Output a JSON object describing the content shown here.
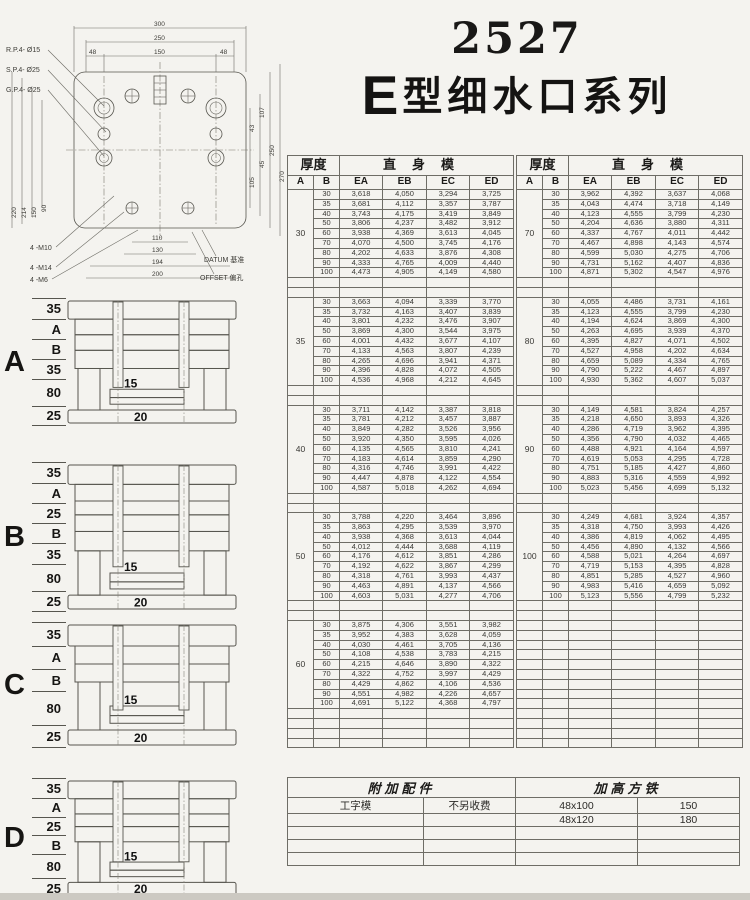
{
  "page": {
    "title_number": "2527",
    "title_series_e": "E",
    "title_series_rest": "型细水口系列"
  },
  "drawing": {
    "hole_labels": [
      "R.P.4- Ø15",
      "S.P.4- Ø25",
      "G.P.4- Ø25"
    ],
    "thread_labels": [
      "4 -M10",
      "4 -M14",
      "4 -M6"
    ],
    "dims_top": [
      "300",
      "250",
      "48",
      "150",
      "48"
    ],
    "dims_right": [
      "43",
      "105",
      "45",
      "107",
      "250",
      "270"
    ],
    "dims_left": [
      "220",
      "214",
      "150",
      "90"
    ],
    "dims_bottom": [
      "110",
      "130",
      "194",
      "200"
    ],
    "datum_label": "DATUM 基准",
    "offset_label": "OFFSET 偏孔"
  },
  "diagrams": [
    {
      "label": "A",
      "dims": [
        "35",
        "A",
        "B",
        "35",
        "80",
        "25"
      ],
      "inner_dim": "15",
      "bottom_dim": "20"
    },
    {
      "label": "B",
      "dims": [
        "35",
        "A",
        "25",
        "B",
        "35",
        "80",
        "25"
      ],
      "inner_dim": "15",
      "bottom_dim": "20"
    },
    {
      "label": "C",
      "dims": [
        "35",
        "A",
        "B",
        "80",
        "25"
      ],
      "inner_dim": "15",
      "bottom_dim": "20"
    },
    {
      "label": "D",
      "dims": [
        "35",
        "A",
        "25",
        "B",
        "80",
        "25"
      ],
      "inner_dim": "15",
      "bottom_dim": "20"
    }
  ],
  "spec_header": {
    "thickness": "厚度",
    "straight": "直身模",
    "col_a": "A",
    "col_b": "B",
    "cols": [
      "EA",
      "EB",
      "EC",
      "ED"
    ]
  },
  "spec_tables": [
    {
      "groups": [
        {
          "a": "30",
          "rows": [
            [
              "30",
              "3,618",
              "4,050",
              "3,294",
              "3,725"
            ],
            [
              "35",
              "3,681",
              "4,112",
              "3,357",
              "3,787"
            ],
            [
              "40",
              "3,743",
              "4,175",
              "3,419",
              "3,849"
            ],
            [
              "50",
              "3,806",
              "4,237",
              "3,482",
              "3,912"
            ],
            [
              "60",
              "3,938",
              "4,369",
              "3,613",
              "4,045"
            ],
            [
              "70",
              "4,070",
              "4,500",
              "3,745",
              "4,176"
            ],
            [
              "80",
              "4,202",
              "4,633",
              "3,876",
              "4,308"
            ],
            [
              "90",
              "4,333",
              "4,765",
              "4,009",
              "4,440"
            ],
            [
              "100",
              "4,473",
              "4,905",
              "4,149",
              "4,580"
            ]
          ]
        },
        {
          "a": "35",
          "rows": [
            [
              "30",
              "3,663",
              "4,094",
              "3,339",
              "3,770"
            ],
            [
              "35",
              "3,732",
              "4,163",
              "3,407",
              "3,839"
            ],
            [
              "40",
              "3,801",
              "4,232",
              "3,476",
              "3,907"
            ],
            [
              "50",
              "3,869",
              "4,300",
              "3,544",
              "3,975"
            ],
            [
              "60",
              "4,001",
              "4,432",
              "3,677",
              "4,107"
            ],
            [
              "70",
              "4,133",
              "4,563",
              "3,807",
              "4,239"
            ],
            [
              "80",
              "4,265",
              "4,696",
              "3,941",
              "4,371"
            ],
            [
              "90",
              "4,396",
              "4,828",
              "4,072",
              "4,505"
            ],
            [
              "100",
              "4,536",
              "4,968",
              "4,212",
              "4,645"
            ]
          ]
        },
        {
          "a": "40",
          "rows": [
            [
              "30",
              "3,711",
              "4,142",
              "3,387",
              "3,818"
            ],
            [
              "35",
              "3,781",
              "4,212",
              "3,457",
              "3,887"
            ],
            [
              "40",
              "3,849",
              "4,282",
              "3,526",
              "3,956"
            ],
            [
              "50",
              "3,920",
              "4,350",
              "3,595",
              "4,026"
            ],
            [
              "60",
              "4,135",
              "4,565",
              "3,810",
              "4,241"
            ],
            [
              "70",
              "4,183",
              "4,614",
              "3,859",
              "4,290"
            ],
            [
              "80",
              "4,316",
              "4,746",
              "3,991",
              "4,422"
            ],
            [
              "90",
              "4,447",
              "4,878",
              "4,122",
              "4,554"
            ],
            [
              "100",
              "4,587",
              "5,018",
              "4,262",
              "4,694"
            ]
          ]
        },
        {
          "a": "50",
          "rows": [
            [
              "30",
              "3,788",
              "4,220",
              "3,464",
              "3,896"
            ],
            [
              "35",
              "3,863",
              "4,295",
              "3,539",
              "3,970"
            ],
            [
              "40",
              "3,938",
              "4,368",
              "3,613",
              "4,044"
            ],
            [
              "50",
              "4,012",
              "4,444",
              "3,688",
              "4,119"
            ],
            [
              "60",
              "4,176",
              "4,612",
              "3,851",
              "4,286"
            ],
            [
              "70",
              "4,192",
              "4,622",
              "3,867",
              "4,299"
            ],
            [
              "80",
              "4,318",
              "4,761",
              "3,993",
              "4,437"
            ],
            [
              "90",
              "4,463",
              "4,891",
              "4,137",
              "4,566"
            ],
            [
              "100",
              "4,603",
              "5,031",
              "4,277",
              "4,706"
            ]
          ]
        },
        {
          "a": "60",
          "rows": [
            [
              "30",
              "3,875",
              "4,306",
              "3,551",
              "3,982"
            ],
            [
              "35",
              "3,952",
              "4,383",
              "3,628",
              "4,059"
            ],
            [
              "40",
              "4,030",
              "4,461",
              "3,705",
              "4,136"
            ],
            [
              "50",
              "4,108",
              "4,538",
              "3,783",
              "4,215"
            ],
            [
              "60",
              "4,215",
              "4,646",
              "3,890",
              "4,322"
            ],
            [
              "70",
              "4,322",
              "4,752",
              "3,997",
              "4,429"
            ],
            [
              "80",
              "4,429",
              "4,862",
              "4,106",
              "4,536"
            ],
            [
              "90",
              "4,551",
              "4,982",
              "4,226",
              "4,657"
            ],
            [
              "100",
              "4,691",
              "5,122",
              "4,368",
              "4,797"
            ]
          ]
        }
      ]
    },
    {
      "groups": [
        {
          "a": "70",
          "rows": [
            [
              "30",
              "3,962",
              "4,392",
              "3,637",
              "4,068"
            ],
            [
              "35",
              "4,043",
              "4,474",
              "3,718",
              "4,149"
            ],
            [
              "40",
              "4,123",
              "4,555",
              "3,799",
              "4,230"
            ],
            [
              "50",
              "4,204",
              "4,636",
              "3,880",
              "4,311"
            ],
            [
              "60",
              "4,337",
              "4,767",
              "4,011",
              "4,442"
            ],
            [
              "70",
              "4,467",
              "4,898",
              "4,143",
              "4,574"
            ],
            [
              "80",
              "4,599",
              "5,030",
              "4,275",
              "4,706"
            ],
            [
              "90",
              "4,731",
              "5,162",
              "4,407",
              "4,836"
            ],
            [
              "100",
              "4,871",
              "5,302",
              "4,547",
              "4,976"
            ]
          ]
        },
        {
          "a": "80",
          "rows": [
            [
              "30",
              "4,055",
              "4,486",
              "3,731",
              "4,161"
            ],
            [
              "35",
              "4,123",
              "4,555",
              "3,799",
              "4,230"
            ],
            [
              "40",
              "4,194",
              "4,624",
              "3,869",
              "4,300"
            ],
            [
              "50",
              "4,263",
              "4,695",
              "3,939",
              "4,370"
            ],
            [
              "60",
              "4,395",
              "4,827",
              "4,071",
              "4,502"
            ],
            [
              "70",
              "4,527",
              "4,958",
              "4,202",
              "4,634"
            ],
            [
              "80",
              "4,659",
              "5,089",
              "4,334",
              "4,765"
            ],
            [
              "90",
              "4,790",
              "5,222",
              "4,467",
              "4,897"
            ],
            [
              "100",
              "4,930",
              "5,362",
              "4,607",
              "5,037"
            ]
          ]
        },
        {
          "a": "90",
          "rows": [
            [
              "30",
              "4,149",
              "4,581",
              "3,824",
              "4,257"
            ],
            [
              "35",
              "4,218",
              "4,650",
              "3,893",
              "4,326"
            ],
            [
              "40",
              "4,286",
              "4,719",
              "3,962",
              "4,395"
            ],
            [
              "50",
              "4,356",
              "4,790",
              "4,032",
              "4,465"
            ],
            [
              "60",
              "4,488",
              "4,921",
              "4,164",
              "4,597"
            ],
            [
              "70",
              "4,619",
              "5,053",
              "4,295",
              "4,728"
            ],
            [
              "80",
              "4,751",
              "5,185",
              "4,427",
              "4,860"
            ],
            [
              "90",
              "4,883",
              "5,316",
              "4,559",
              "4,992"
            ],
            [
              "100",
              "5,023",
              "5,456",
              "4,699",
              "5,132"
            ]
          ]
        },
        {
          "a": "100",
          "rows": [
            [
              "30",
              "4,249",
              "4,681",
              "3,924",
              "4,357"
            ],
            [
              "35",
              "4,318",
              "4,750",
              "3,993",
              "4,426"
            ],
            [
              "40",
              "4,386",
              "4,819",
              "4,062",
              "4,495"
            ],
            [
              "50",
              "4,456",
              "4,890",
              "4,132",
              "4,566"
            ],
            [
              "60",
              "4,588",
              "5,021",
              "4,264",
              "4,697"
            ],
            [
              "70",
              "4,719",
              "5,153",
              "4,395",
              "4,828"
            ],
            [
              "80",
              "4,851",
              "5,285",
              "4,527",
              "4,960"
            ],
            [
              "90",
              "4,983",
              "5,416",
              "4,659",
              "5,092"
            ],
            [
              "100",
              "5,123",
              "5,556",
              "4,799",
              "5,232"
            ]
          ]
        }
      ]
    }
  ],
  "accessories": {
    "left_header": "附加配件",
    "right_header": "加高方铁",
    "rows": [
      [
        "工字模",
        "不另收费",
        "48x100",
        "150"
      ],
      [
        "",
        "",
        "48x120",
        "180"
      ],
      [
        "",
        "",
        "",
        ""
      ],
      [
        "",
        "",
        "",
        ""
      ],
      [
        "",
        "",
        "",
        ""
      ]
    ]
  }
}
